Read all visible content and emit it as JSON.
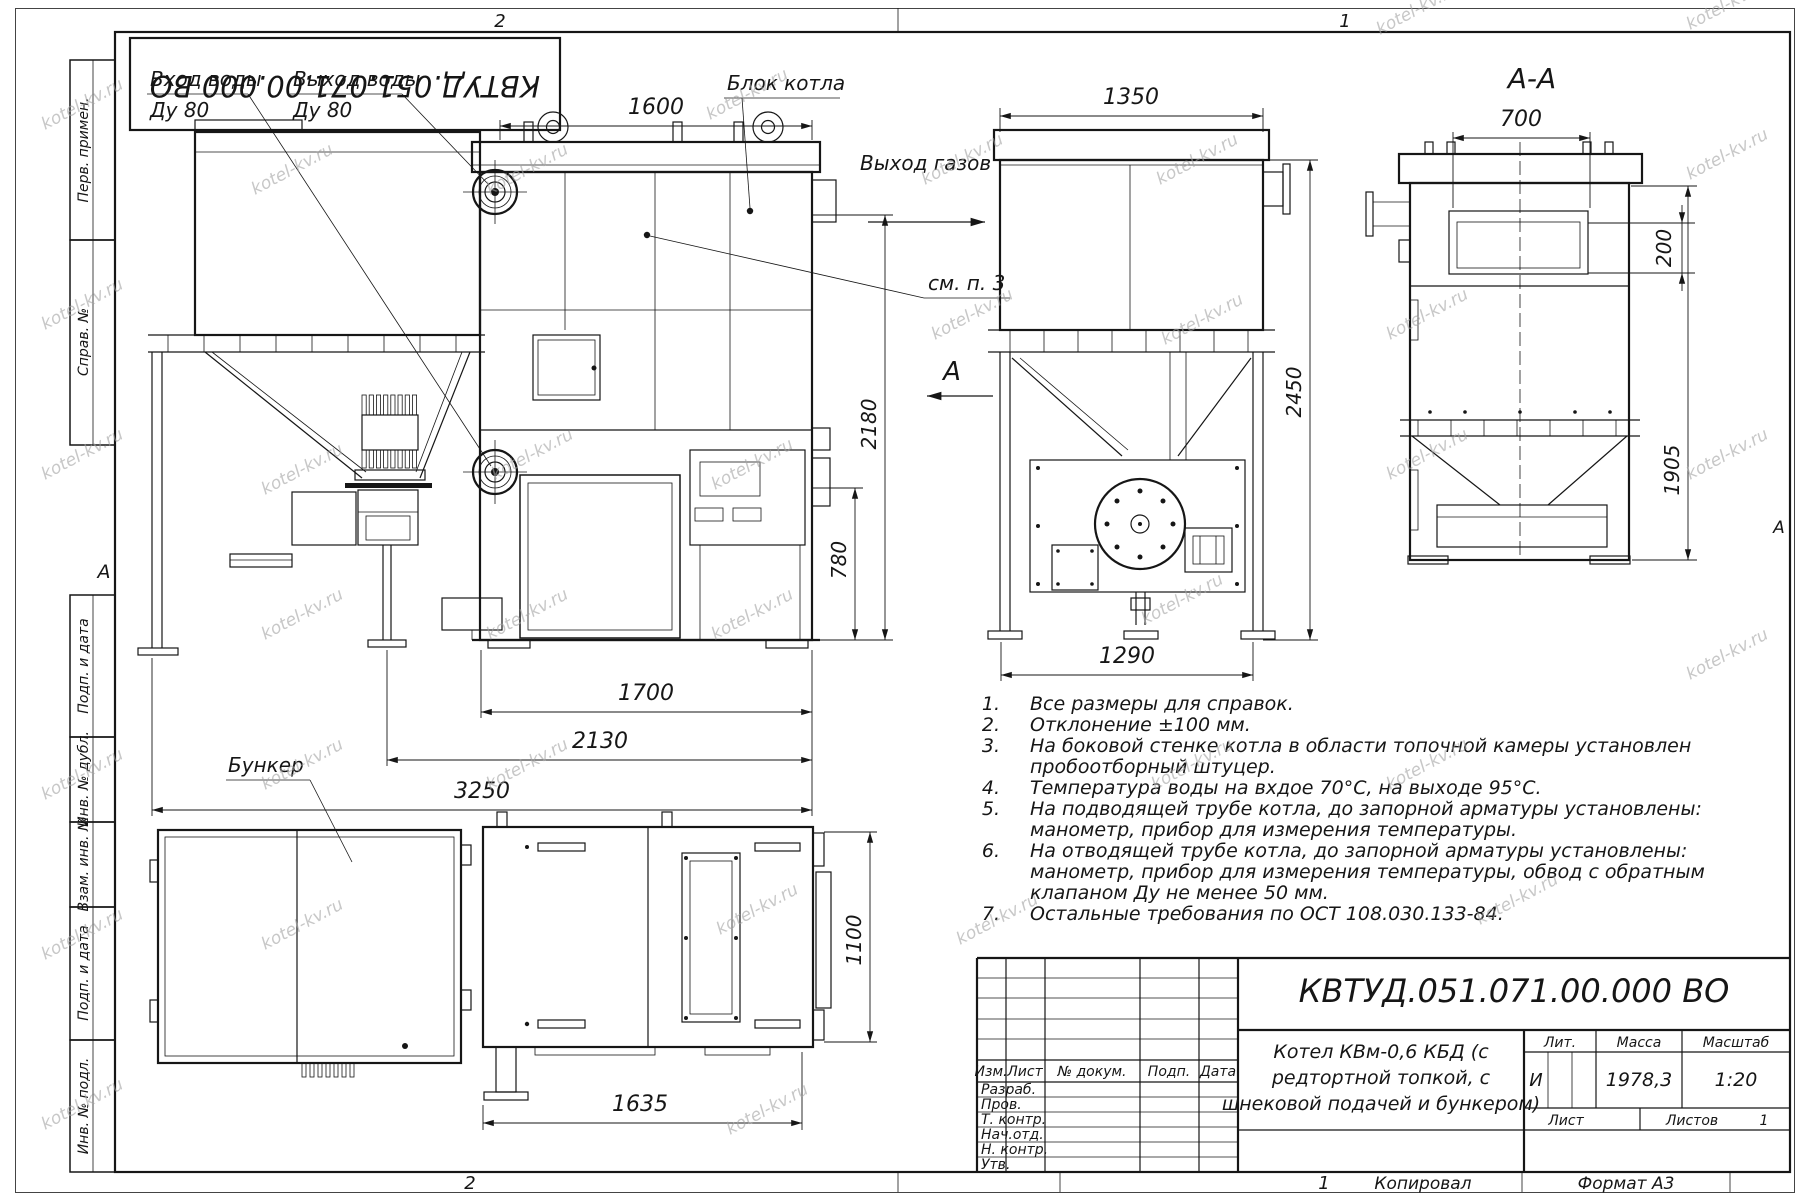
{
  "watermark": "kotel-kv.ru",
  "sheet": {
    "zone_top_left": "2",
    "zone_top_right": "1",
    "zone_bottom_left": "2",
    "zone_bottom_right": "1",
    "copied": "Копировал",
    "format": "Формат А3",
    "margin_letter_left": "А",
    "margin_letter_right": "А"
  },
  "stamp": {
    "doc_number": "КВТУД.051.071.00.000 ВО"
  },
  "sidebar": {
    "items": [
      {
        "label": "Перв. примен."
      },
      {
        "label": "Справ. №"
      },
      {
        "label": "Подп. и дата"
      },
      {
        "label": "Инв. № дубл."
      },
      {
        "label": "Взам. инв. №"
      },
      {
        "label": "Подп. и дата"
      },
      {
        "label": "Инв. № подл."
      }
    ]
  },
  "callouts": {
    "water_in_line1": "Вход воды",
    "water_in_line2": "Ду 80",
    "water_out_line1": "Выход воды",
    "water_out_line2": "Ду 80",
    "boiler_block": "Блок котла",
    "gas_outlet": "Выход газов",
    "see_note": "см. п. 3",
    "bunker": "Бункер",
    "section_letter": "А",
    "section_view_title": "А-А"
  },
  "dims": {
    "front_top": "1600",
    "front_height": "2180",
    "front_lower": "780",
    "front_w1": "1700",
    "front_w2": "2130",
    "front_w3": "3250",
    "rear_top": "1350",
    "rear_height": "2450",
    "rear_bottom": "1290",
    "section_top": "700",
    "section_offset": "200",
    "section_height": "1905",
    "plan_width": "1635",
    "plan_depth": "1100"
  },
  "notes": [
    {
      "num": "1.",
      "lines": [
        "Все размеры для справок."
      ]
    },
    {
      "num": "2.",
      "lines": [
        "Отклонение ±100 мм."
      ]
    },
    {
      "num": "3.",
      "lines": [
        "На боковой стенке котла в области топочной камеры установлен",
        "пробоотборный штуцер."
      ]
    },
    {
      "num": "4.",
      "lines": [
        "Температура воды на вхдое 70°С, на выходе 95°С."
      ]
    },
    {
      "num": "5.",
      "lines": [
        "На подводящей трубе котла, до запорной арматуры установлены:",
        "манометр, прибор для измерения температуры."
      ]
    },
    {
      "num": "6.",
      "lines": [
        "На отводящей трубе котла, до запорной арматуры установлены:",
        "манометр, прибор для измерения температуры, обвод с обратным",
        "клапаном Ду не менее 50 мм."
      ]
    },
    {
      "num": "7.",
      "lines": [
        "Остальные требования по ОСТ 108.030.133-84."
      ]
    }
  ],
  "title_block": {
    "doc_number": "КВТУД.051.071.00.000 ВО",
    "name_line1": "Котел КВм-0,6 КБД (с",
    "name_line2": "редтортной топкой, с",
    "name_line3": "шнековой подачей и бункером)",
    "col_izm": "Изм.",
    "col_list": "Лист",
    "col_doc": "№ докум.",
    "col_sign": "Подп.",
    "col_date": "Дата",
    "rows": [
      {
        "label": "Разраб."
      },
      {
        "label": "Пров."
      },
      {
        "label": "Т. контр."
      },
      {
        "label": "Нач.отд."
      },
      {
        "label": "Н. контр."
      },
      {
        "label": "Утв."
      }
    ],
    "lit_label": "Лит.",
    "lit_value": "И",
    "mass_label": "Масса",
    "mass_value": "1978,3",
    "scale_label": "Масштаб",
    "scale_value": "1:20",
    "sheet_label": "Лист",
    "sheets_label": "Листов",
    "sheets_count": "1"
  }
}
